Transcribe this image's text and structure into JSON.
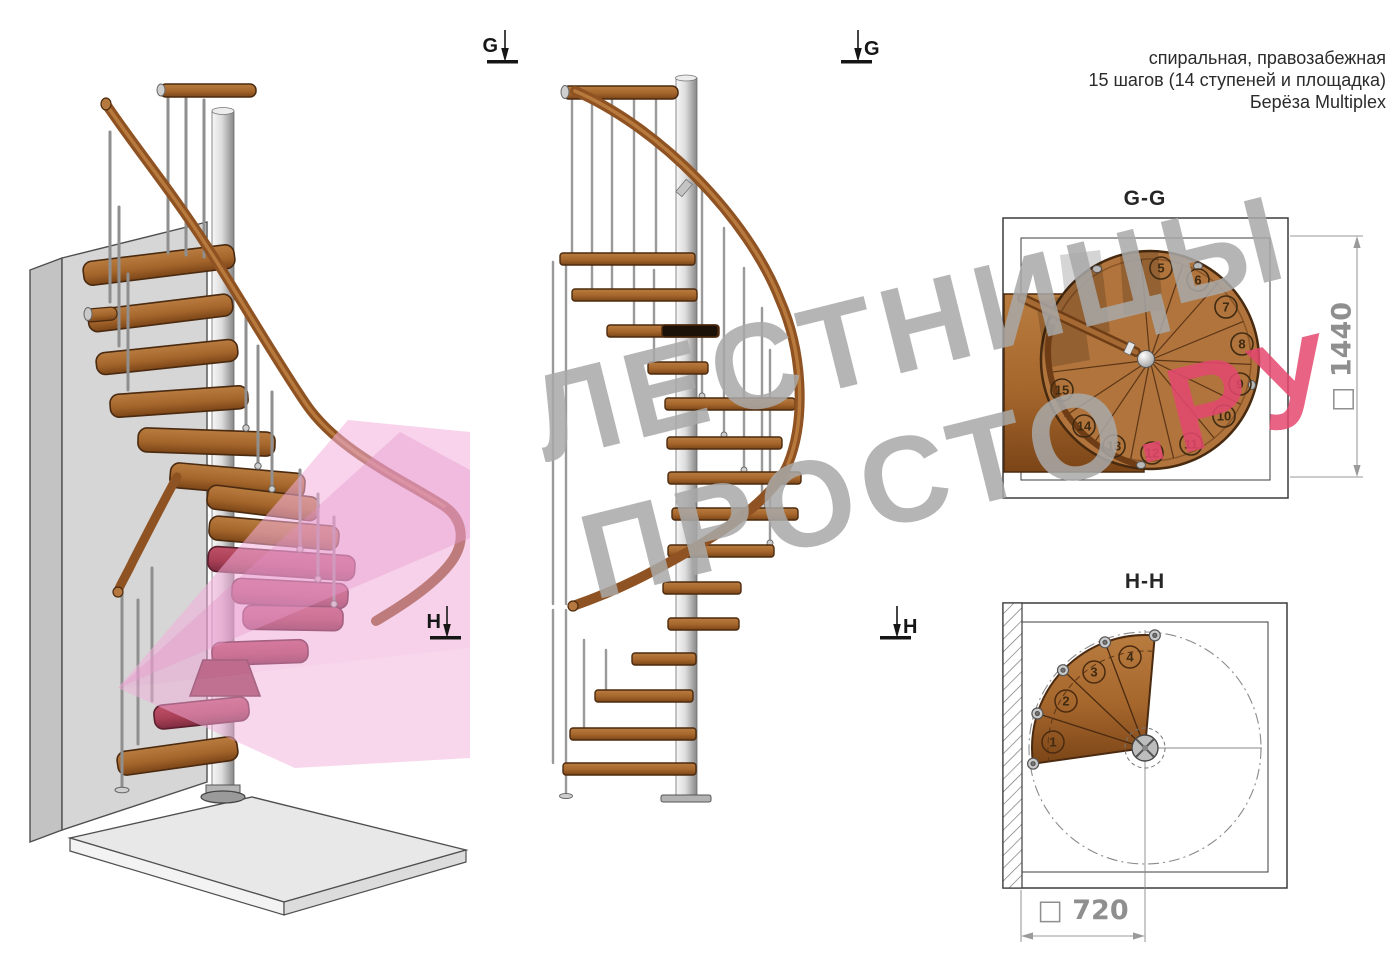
{
  "header": {
    "line1": "спиральная, правозабежная",
    "line2": "15 шагов (14 ступеней и площадка)",
    "line3": "Берёза Multiplex"
  },
  "watermark": {
    "line1": "ЛЕСТНИЦЫ",
    "line2_gray": "ПРОСТО",
    "line2_red": ".РУ",
    "gray_color": "#a9a9a9",
    "red_color": "#e4486f",
    "pink_overlay_color": "#f2aeda"
  },
  "markers": {
    "g_left": "G",
    "g_right": "G",
    "h_left": "H",
    "h_right": "H"
  },
  "gg_plan": {
    "title": "G-G",
    "dimension": "□ 1440",
    "step_numbers": [
      "5",
      "6",
      "7",
      "8",
      "9",
      "10",
      "11",
      "12",
      "13",
      "14",
      "15"
    ]
  },
  "hh_plan": {
    "title": "H-H",
    "dimension": "□ 720",
    "step_numbers": [
      "1",
      "2",
      "3",
      "4"
    ]
  },
  "colors": {
    "wood_top": "#b0743c",
    "wood_dark": "#78431a",
    "wood_outline": "#4a2a10",
    "red_step": "#b44a61",
    "handrail": "#8f5222",
    "metal_pole": "#c9c9c9",
    "dimension_gray": "#8f8f8f"
  }
}
